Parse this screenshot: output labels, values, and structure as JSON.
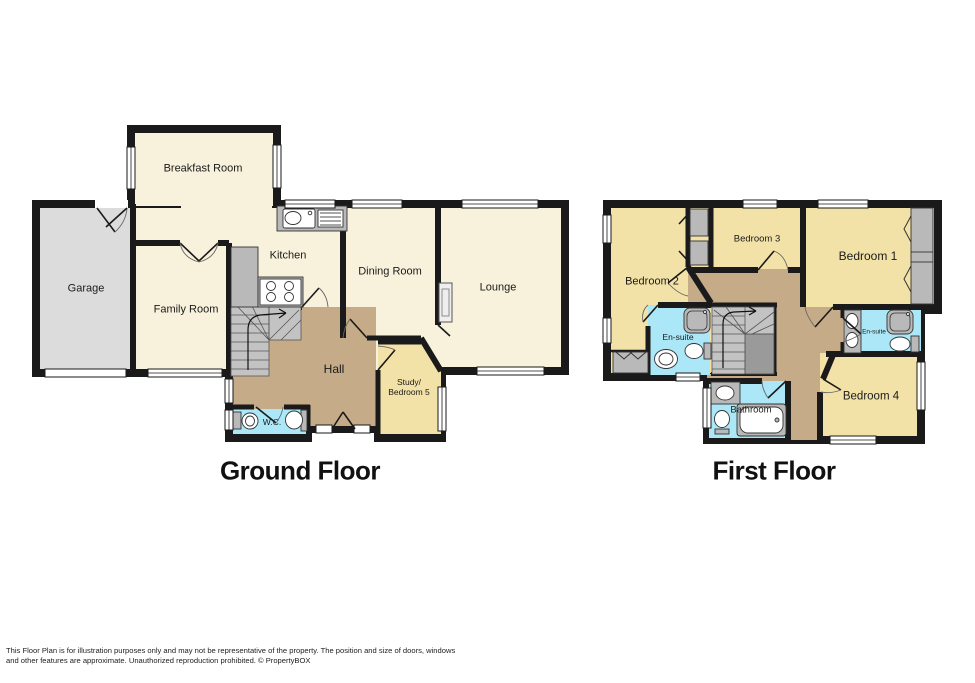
{
  "ground_floor": {
    "title": "Ground Floor",
    "rooms": {
      "breakfast": "Breakfast Room",
      "garage": "Garage",
      "kitchen": "Kitchen",
      "family": "Family Room",
      "dining": "Dining Room",
      "lounge": "Lounge",
      "hall": "Hall",
      "study_line1": "Study/",
      "study_line2": "Bedroom 5",
      "wc": "W.C."
    }
  },
  "first_floor": {
    "title": "First Floor",
    "rooms": {
      "bedroom1": "Bedroom 1",
      "bedroom2": "Bedroom 2",
      "bedroom3": "Bedroom 3",
      "bedroom4": "Bedroom 4",
      "ensuite_left": "En-suite",
      "ensuite_right": "En-suite",
      "bathroom": "Bathroom"
    }
  },
  "footer": {
    "line1": "This Floor Plan is for illustration purposes only and may not be representative of the property. The position and size of doors, windows",
    "line2": "and other features are approximate. Unauthorized reproduction prohibited. © PropertyBOX"
  },
  "colors": {
    "wall": "#1a1a1a",
    "room_cream": "#f8f2dc",
    "room_yellow": "#f3e2a8",
    "hall_tan": "#c5ab88",
    "wet_room_cyan": "#abe7f6",
    "garage_grey": "#dcdcdc",
    "fixture_grey": "#b9b9b9",
    "stairs_grey": "#c3c3c3"
  }
}
